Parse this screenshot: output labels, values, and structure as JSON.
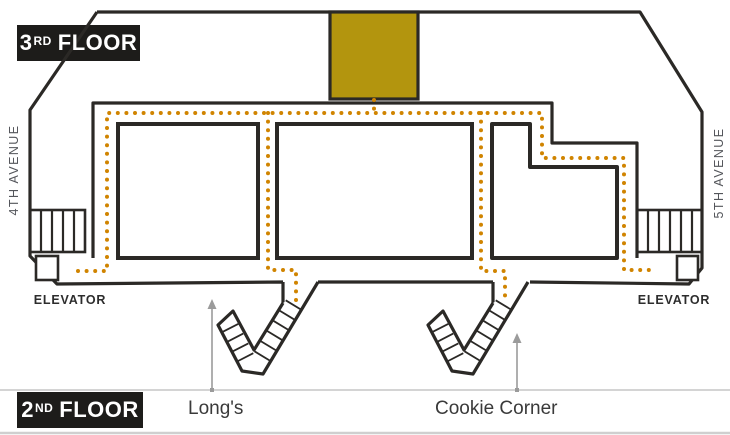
{
  "map_title": "Mall floor wayfinding map",
  "badges": {
    "third": {
      "number": "3",
      "ordinal": "RD",
      "word": "FLOOR"
    },
    "second": {
      "number": "2",
      "ordinal": "ND",
      "word": "FLOOR"
    }
  },
  "streets": {
    "left": "4TH AVENUE",
    "right": "5TH AVENUE"
  },
  "elevators": {
    "left": "ELEVATOR",
    "right": "ELEVATOR"
  },
  "stores": [
    {
      "name": "Long's"
    },
    {
      "name": "Cookie Corner"
    }
  ],
  "colors": {
    "wall": "#2b2926",
    "route_dots": "#d08400",
    "highlight_room": "#b3950e",
    "badge_bg": "#1d1c1a",
    "badge_text": "#ffffff",
    "street_text": "#54565b",
    "elevator_text": "#2d2d2d",
    "store_text": "#3a3a3a",
    "arrow": "#9b9b9b",
    "divider_line": "#c6c6c6"
  }
}
